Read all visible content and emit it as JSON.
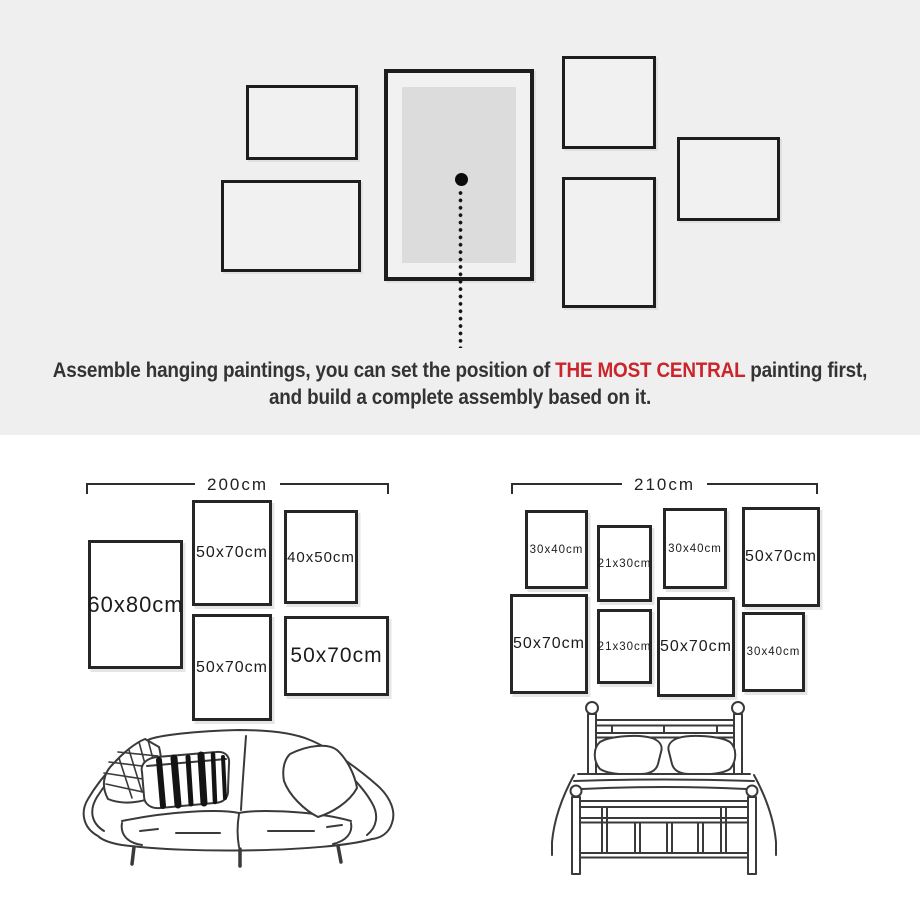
{
  "instruction": {
    "line1_prefix": "Assemble hanging paintings, you can set the position of ",
    "highlight": "THE MOST CENTRAL",
    "line1_suffix": " painting first,",
    "line2": "and build a complete assembly based on it.",
    "highlight_color": "#c9252b"
  },
  "colors": {
    "hero_background": "#efefef",
    "frame_border": "#1d1d1d",
    "central_mat": "#dcdcdc"
  },
  "plans": {
    "left": {
      "width_label": "200cm",
      "furniture": "sofa",
      "frames": [
        {
          "size": "60x80cm"
        },
        {
          "size": "50x70cm"
        },
        {
          "size": "40x50cm"
        },
        {
          "size": "50x70cm"
        },
        {
          "size": "50x70cm"
        }
      ]
    },
    "right": {
      "width_label": "210cm",
      "furniture": "bed",
      "frames": [
        {
          "size": "30x40cm"
        },
        {
          "size": "21x30cm"
        },
        {
          "size": "30x40cm"
        },
        {
          "size": "50x70cm"
        },
        {
          "size": "50x70cm"
        },
        {
          "size": "21x30cm"
        },
        {
          "size": "50x70cm"
        },
        {
          "size": "30x40cm"
        }
      ]
    }
  }
}
